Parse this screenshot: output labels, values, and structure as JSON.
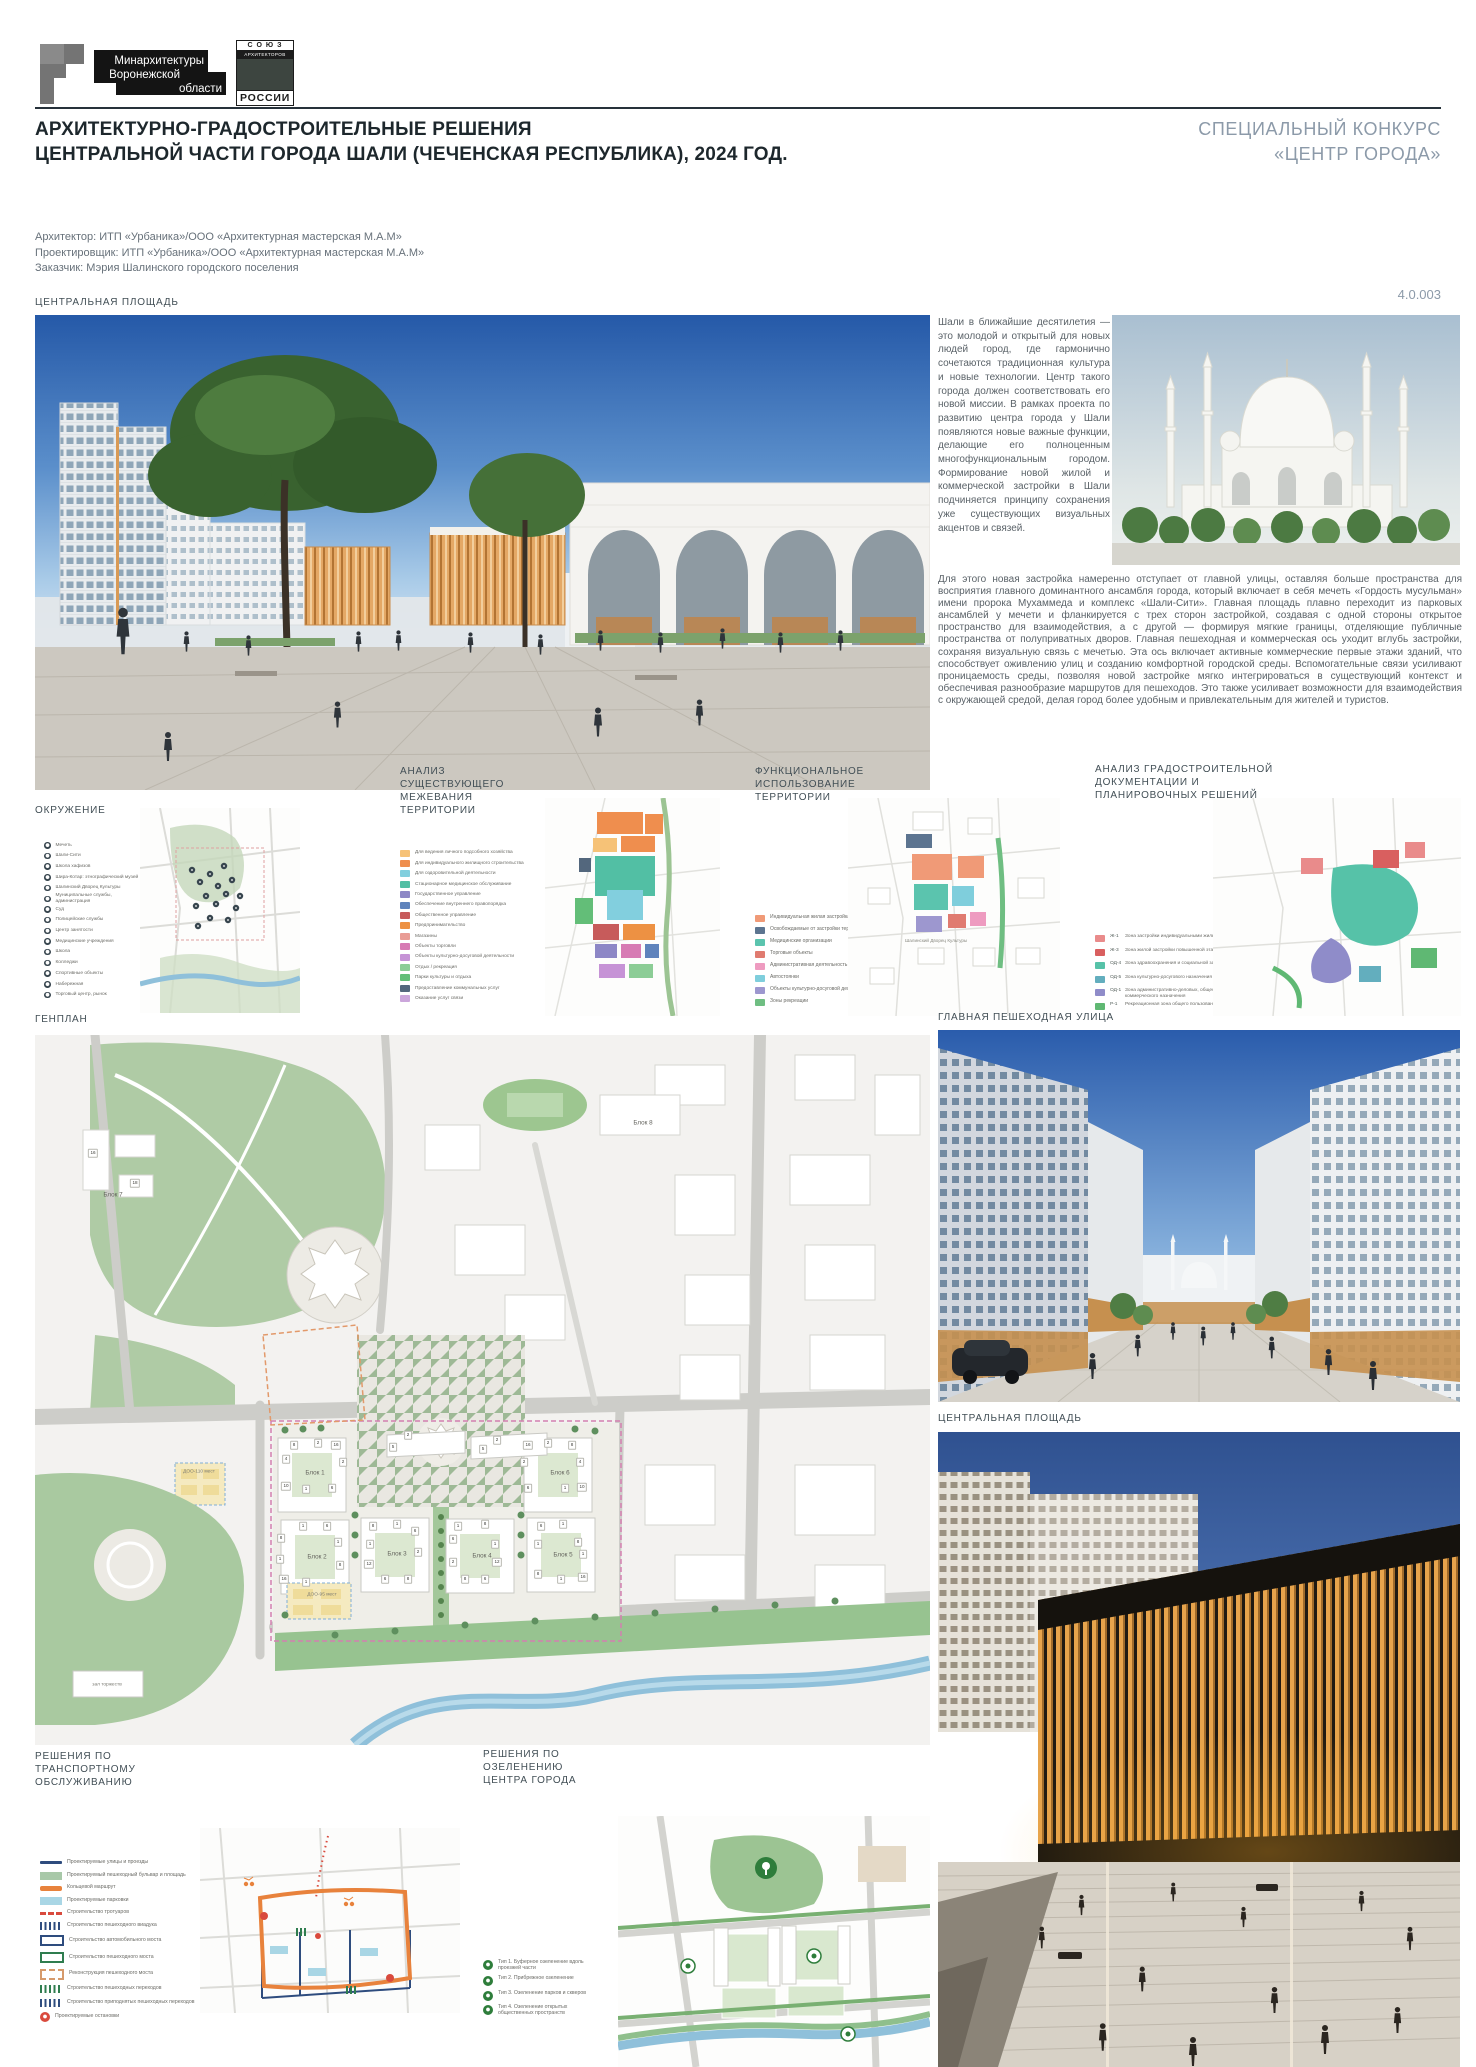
{
  "header": {
    "ministry_logo_lines": [
      "Минархитектуры",
      "Воронежской",
      "области"
    ],
    "union_logo": {
      "top": "С О Ю З",
      "mid": "АРХИТЕКТОРОВ",
      "bottom": "РОССИИ"
    },
    "title_lines": [
      "АРХИТЕКТУРНО-ГРАДОСТРОИТЕЛЬНЫЕ РЕШЕНИЯ",
      "ЦЕНТРАЛЬНОЙ ЧАСТИ ГОРОДА ШАЛИ (ЧЕЧЕНСКАЯ РЕСПУБЛИКА), 2024 ГОД."
    ],
    "contest_lines": [
      "СПЕЦИАЛЬНЫЙ КОНКУРС",
      "«ЦЕНТР ГОРОДА»"
    ],
    "credits": [
      "Архитектор: ИТП «Урбаника»/ООО «Архитектурная мастерская М.А.М»",
      "Проектировщик: ИТП «Урбаника»/ООО «Архитектурная мастерская М.А.М»",
      "Заказчик: Мэрия Шалинского городского поселения"
    ],
    "sheet_number": "4.0.003",
    "accent_color": "#8C9AA9"
  },
  "sections": {
    "central_square": "ЦЕНТРАЛЬНАЯ ПЛОЩАДЬ",
    "surroundings": "ОКРУЖЕНИЕ",
    "parceling": "АНАЛИЗ СУЩЕСТВУЮЩЕГО МЕЖЕВАНИЯ ТЕРРИТОРИИ",
    "functional": "ФУНКЦИОНАЛЬНОЕ ИСПОЛЬЗОВАНИЕ ТЕРРИТОРИИ",
    "urban_docs": "АНАЛИЗ ГРАДОСТРОИТЕЛЬНОЙ ДОКУМЕНТАЦИИ И ПЛАНИРОВОЧНЫХ РЕШЕНИЙ",
    "genplan": "ГЕНПЛАН",
    "main_street": "ГЛАВНАЯ ПЕШЕХОДНАЯ УЛИЦА",
    "central_square_2": "ЦЕНТРАЛЬНАЯ ПЛОЩАДЬ",
    "transport": "РЕШЕНИЯ ПО ТРАНСПОРТНОМУ ОБСЛУЖИВАНИЮ",
    "greening": "РЕШЕНИЯ ПО ОЗЕЛЕНЕНИЮ ЦЕНТРА ГОРОДА"
  },
  "texts": {
    "intro": "Шали в ближайшие десятилетия — это молодой и открытый для новых людей город, где гармонично сочетаются традиционная культура и новые технологии. Центр такого города должен соответствовать его новой миссии. В рамках проекта по развитию центра города у Шали появляются новые важные функции, делающие его полноценным многофункциональным городом. Формирование новой жилой и коммерческой застройки в Шали подчиняется принципу сохранения уже существующих визуальных акцентов и связей.",
    "body": "Для этого новая застройка намеренно отступает от главной улицы, оставляя больше пространства для восприятия главного доминантного ансамбля города, который включает в себя мечеть «Гордость мусульман» имени пророка Мухаммеда и комплекс «Шали-Сити». Главная площадь плавно переходит из парковых ансамблей у мечети и фланкируется с трех сторон застройкой, создавая с одной стороны открытое пространство для взаимодействия, а с другой — формируя мягкие границы, отделяющие публичные пространства от полуприватных дворов. Главная пешеходная и коммерческая ось уходит вглубь застройки, сохраняя визуальную связь с мечетью. Эта ось включает активные коммерческие первые этажи зданий, что способствует оживлению улиц и созданию комфортной городской среды. Вспомогательные связи усиливают проницаемость среды, позволяя новой застройке мягко интегрироваться в существующий контекст и обеспечивая разнообразие маршрутов для пешеходов. Это также усиливает возможности для взаимодействия с окружающей средой, делая город более удобным и привлекательным для жителей и туристов."
  },
  "legends": {
    "surroundings": [
      {
        "type": "dot",
        "color": "#37454e",
        "label": "Мечеть"
      },
      {
        "type": "dot",
        "color": "#37454e",
        "label": "Шали-Сити"
      },
      {
        "type": "dot",
        "color": "#37454e",
        "label": "Школа хафизов"
      },
      {
        "type": "dot",
        "color": "#37454e",
        "label": "Шира-Котар: этнографический музей"
      },
      {
        "type": "dot",
        "color": "#37454e",
        "label": "Шалинский Дворец Культуры"
      },
      {
        "type": "dot",
        "color": "#37454e",
        "label": "Муниципальные службы, администрация"
      },
      {
        "type": "dot",
        "color": "#37454e",
        "label": "Суд"
      },
      {
        "type": "dot",
        "color": "#37454e",
        "label": "Полицейские службы"
      },
      {
        "type": "dot",
        "color": "#37454e",
        "label": "Центр занятости"
      },
      {
        "type": "dot",
        "color": "#37454e",
        "label": "Медицинские учреждения"
      },
      {
        "type": "dot",
        "color": "#37454e",
        "label": "Школа"
      },
      {
        "type": "dot",
        "color": "#37454e",
        "label": "Колледжи"
      },
      {
        "type": "dot",
        "color": "#37454e",
        "label": "Спортивные объекты"
      },
      {
        "type": "dot",
        "color": "#37454e",
        "label": "Набережная"
      },
      {
        "type": "dot",
        "color": "#37454e",
        "label": "Торговый центр, рынок"
      }
    ],
    "parceling": [
      {
        "type": "square",
        "color": "#f6c277",
        "label": "Для ведения личного подсобного хозяйства"
      },
      {
        "type": "square",
        "color": "#ef8e4e",
        "label": "Для индивидуального жилищного строительства"
      },
      {
        "type": "square",
        "color": "#82cfde",
        "label": "Для оздоровительной деятельности"
      },
      {
        "type": "square",
        "color": "#52bfa4",
        "label": "Стационарное медицинское обслуживание"
      },
      {
        "type": "square",
        "color": "#8d87c6",
        "label": "Государственное управление"
      },
      {
        "type": "square",
        "color": "#5f83bc",
        "label": "Обеспечение внутреннего правопорядка"
      },
      {
        "type": "square",
        "color": "#c75b5b",
        "label": "Общественное управление"
      },
      {
        "type": "square",
        "color": "#ed9143",
        "label": "Предпринимательство"
      },
      {
        "type": "square",
        "color": "#e99c95",
        "label": "Магазины"
      },
      {
        "type": "square",
        "color": "#d77bb4",
        "label": "Объекты торговли"
      },
      {
        "type": "square",
        "color": "#c693d6",
        "label": "Объекты культурно-досуговой деятельности"
      },
      {
        "type": "square",
        "color": "#8ccd96",
        "label": "Отдых / рекреация"
      },
      {
        "type": "square",
        "color": "#63be78",
        "label": "Парки культуры и отдыха"
      },
      {
        "type": "square",
        "color": "#53677d",
        "label": "Предоставление коммунальных услуг"
      },
      {
        "type": "square",
        "color": "#cba6db",
        "label": "Оказание услуг связи"
      }
    ],
    "functional": [
      {
        "type": "square",
        "color": "#f09a77",
        "label": "Индивидуальная жилая застройка"
      },
      {
        "type": "square",
        "color": "#5c7490",
        "label": "Освобождаемые от застройки территории"
      },
      {
        "type": "square",
        "color": "#5bc4ae",
        "label": "Медицинские организации"
      },
      {
        "type": "square",
        "color": "#e07b70",
        "label": "Торговые объекты"
      },
      {
        "type": "square",
        "color": "#ee9bc0",
        "label": "Административная деятельность"
      },
      {
        "type": "square",
        "color": "#7fcedc",
        "label": "Автостоянки"
      },
      {
        "type": "square",
        "color": "#9d97cf",
        "label": "Объекты культурно-досуговой деятельности"
      },
      {
        "type": "square",
        "color": "#6fbe82",
        "label": "Зоны рекреации"
      }
    ],
    "urban_docs": [
      {
        "type": "square",
        "color": "#e98b8b",
        "code": "Ж-1",
        "label": "Зона застройки индивидуальными жилыми домами"
      },
      {
        "type": "square",
        "color": "#d95f5f",
        "code": "Ж-3",
        "label": "Зона жилой застройки повышенной этажности"
      },
      {
        "type": "square",
        "color": "#56c2a8",
        "code": "ОД-4",
        "label": "Зона здравоохранения и социальной защиты"
      },
      {
        "type": "square",
        "color": "#63aebe",
        "code": "ОД-5",
        "label": "Зона культурно-досугового назначения"
      },
      {
        "type": "square",
        "color": "#8f8cc9",
        "code": "ОД-1",
        "label": "Зона административно-деловых, общественного и коммерческого назначения"
      },
      {
        "type": "square",
        "color": "#5fb873",
        "code": "Р-1",
        "label": "Рекреационная зона общего пользования"
      }
    ],
    "transport": [
      {
        "type": "line",
        "color": "#2e4c7e",
        "label": "Проектируемые улицы и проезды"
      },
      {
        "type": "fill",
        "color": "#a8c8a8",
        "label": "Проектируемый пешеходный бульвар и площадь"
      },
      {
        "type": "linethick",
        "color": "#e8823c",
        "label": "Кольцевой маршрут"
      },
      {
        "type": "fill",
        "color": "#a9d6e5",
        "label": "Проектируемые парковки"
      },
      {
        "type": "dash",
        "color": "#d94a3d",
        "label": "Строительство тротуаров"
      },
      {
        "type": "bars",
        "color": "#2e4c7e",
        "label": "Строительство пешеходного виадука"
      },
      {
        "type": "outline",
        "color": "#2e4c7e",
        "label": "Строительство автомобильного моста"
      },
      {
        "type": "outline",
        "color": "#2f7d4f",
        "label": "Строительство пешеходного моста"
      },
      {
        "type": "outlinedash",
        "color": "#d69a6b",
        "label": "Реконструкция пешеходного моста"
      },
      {
        "type": "bars",
        "color": "#2f7d4f",
        "label": "Строительство пешеходных переходов"
      },
      {
        "type": "bars",
        "color": "#2e4c7e",
        "label": "Строительство приподнятых пешеходных переходов"
      },
      {
        "type": "circle",
        "color": "#d94a3d",
        "label": "Проектируемые остановки"
      }
    ],
    "greening": [
      {
        "type": "gcircle",
        "color": "#2e7d3b",
        "label": "Тип 1. Буферное озеленение вдоль проезжей части"
      },
      {
        "type": "gcircle",
        "color": "#2e7d3b",
        "label": "Тип 2. Прибрежное озеленение"
      },
      {
        "type": "gcircle",
        "color": "#2e7d3b",
        "label": "Тип 3. Озеленение парков и скверов"
      },
      {
        "type": "gcircle",
        "color": "#2e7d3b",
        "label": "Тип 4. Озеленение открытых общественных пространств"
      }
    ]
  },
  "map_annotations": {
    "functional_label": "Шалинский Дворец Культуры"
  },
  "genplan_labels": [
    {
      "k": "block",
      "x": 280,
      "y": 438,
      "t": "Блок 1"
    },
    {
      "k": "block",
      "x": 282,
      "y": 522,
      "t": "Блок 2"
    },
    {
      "k": "block",
      "x": 362,
      "y": 519,
      "t": "Блок 3"
    },
    {
      "k": "block",
      "x": 447,
      "y": 521,
      "t": "Блок 4"
    },
    {
      "k": "block",
      "x": 528,
      "y": 520,
      "t": "Блок 5"
    },
    {
      "k": "block",
      "x": 525,
      "y": 438,
      "t": "Блок 6"
    },
    {
      "k": "block",
      "x": 78,
      "y": 160,
      "t": "Блок 7"
    },
    {
      "k": "block",
      "x": 608,
      "y": 88,
      "t": "Блок 8"
    },
    {
      "k": "small",
      "x": 72,
      "y": 650,
      "t": "зал торжеств"
    },
    {
      "k": "small",
      "x": 164,
      "y": 437,
      "t": "ДОО-110 мест"
    },
    {
      "k": "small",
      "x": 287,
      "y": 560,
      "t": "ДОО-95 мест"
    },
    {
      "k": "chip",
      "x": 259,
      "y": 410,
      "t": "8"
    },
    {
      "k": "chip",
      "x": 283,
      "y": 408,
      "t": "2"
    },
    {
      "k": "chip",
      "x": 301,
      "y": 410,
      "t": "16"
    },
    {
      "k": "chip",
      "x": 251,
      "y": 424,
      "t": "4"
    },
    {
      "k": "chip",
      "x": 308,
      "y": 427,
      "t": "2"
    },
    {
      "k": "chip",
      "x": 251,
      "y": 451,
      "t": "10"
    },
    {
      "k": "chip",
      "x": 271,
      "y": 454,
      "t": "1"
    },
    {
      "k": "chip",
      "x": 297,
      "y": 453,
      "t": "6"
    },
    {
      "k": "chip",
      "x": 493,
      "y": 410,
      "t": "16"
    },
    {
      "k": "chip",
      "x": 513,
      "y": 408,
      "t": "2"
    },
    {
      "k": "chip",
      "x": 537,
      "y": 410,
      "t": "8"
    },
    {
      "k": "chip",
      "x": 489,
      "y": 427,
      "t": "2"
    },
    {
      "k": "chip",
      "x": 545,
      "y": 427,
      "t": "4"
    },
    {
      "k": "chip",
      "x": 493,
      "y": 453,
      "t": "6"
    },
    {
      "k": "chip",
      "x": 530,
      "y": 453,
      "t": "1"
    },
    {
      "k": "chip",
      "x": 547,
      "y": 452,
      "t": "10"
    },
    {
      "k": "chip",
      "x": 373,
      "y": 400,
      "t": "2"
    },
    {
      "k": "chip",
      "x": 358,
      "y": 412,
      "t": "5"
    },
    {
      "k": "chip",
      "x": 462,
      "y": 405,
      "t": "2"
    },
    {
      "k": "chip",
      "x": 448,
      "y": 414,
      "t": "5"
    },
    {
      "k": "chip",
      "x": 268,
      "y": 491,
      "t": "1"
    },
    {
      "k": "chip",
      "x": 292,
      "y": 491,
      "t": "6"
    },
    {
      "k": "chip",
      "x": 246,
      "y": 503,
      "t": "8"
    },
    {
      "k": "chip",
      "x": 303,
      "y": 507,
      "t": "1"
    },
    {
      "k": "chip",
      "x": 245,
      "y": 524,
      "t": "1"
    },
    {
      "k": "chip",
      "x": 305,
      "y": 530,
      "t": "8"
    },
    {
      "k": "chip",
      "x": 249,
      "y": 544,
      "t": "16"
    },
    {
      "k": "chip",
      "x": 271,
      "y": 547,
      "t": "1"
    },
    {
      "k": "chip",
      "x": 338,
      "y": 491,
      "t": "8"
    },
    {
      "k": "chip",
      "x": 362,
      "y": 489,
      "t": "1"
    },
    {
      "k": "chip",
      "x": 380,
      "y": 496,
      "t": "6"
    },
    {
      "k": "chip",
      "x": 335,
      "y": 509,
      "t": "1"
    },
    {
      "k": "chip",
      "x": 383,
      "y": 517,
      "t": "2"
    },
    {
      "k": "chip",
      "x": 334,
      "y": 529,
      "t": "12"
    },
    {
      "k": "chip",
      "x": 350,
      "y": 544,
      "t": "6"
    },
    {
      "k": "chip",
      "x": 373,
      "y": 544,
      "t": "8"
    },
    {
      "k": "chip",
      "x": 423,
      "y": 491,
      "t": "1"
    },
    {
      "k": "chip",
      "x": 450,
      "y": 489,
      "t": "8"
    },
    {
      "k": "chip",
      "x": 418,
      "y": 504,
      "t": "6"
    },
    {
      "k": "chip",
      "x": 460,
      "y": 509,
      "t": "1"
    },
    {
      "k": "chip",
      "x": 418,
      "y": 527,
      "t": "2"
    },
    {
      "k": "chip",
      "x": 462,
      "y": 527,
      "t": "12"
    },
    {
      "k": "chip",
      "x": 430,
      "y": 544,
      "t": "8"
    },
    {
      "k": "chip",
      "x": 450,
      "y": 544,
      "t": "6"
    },
    {
      "k": "chip",
      "x": 506,
      "y": 491,
      "t": "6"
    },
    {
      "k": "chip",
      "x": 528,
      "y": 489,
      "t": "1"
    },
    {
      "k": "chip",
      "x": 503,
      "y": 509,
      "t": "1"
    },
    {
      "k": "chip",
      "x": 543,
      "y": 507,
      "t": "8"
    },
    {
      "k": "chip",
      "x": 548,
      "y": 519,
      "t": "1"
    },
    {
      "k": "chip",
      "x": 503,
      "y": 539,
      "t": "8"
    },
    {
      "k": "chip",
      "x": 526,
      "y": 544,
      "t": "1"
    },
    {
      "k": "chip",
      "x": 548,
      "y": 542,
      "t": "16"
    },
    {
      "k": "chip",
      "x": 58,
      "y": 118,
      "t": "16"
    },
    {
      "k": "chip",
      "x": 100,
      "y": 148,
      "t": "18"
    }
  ]
}
